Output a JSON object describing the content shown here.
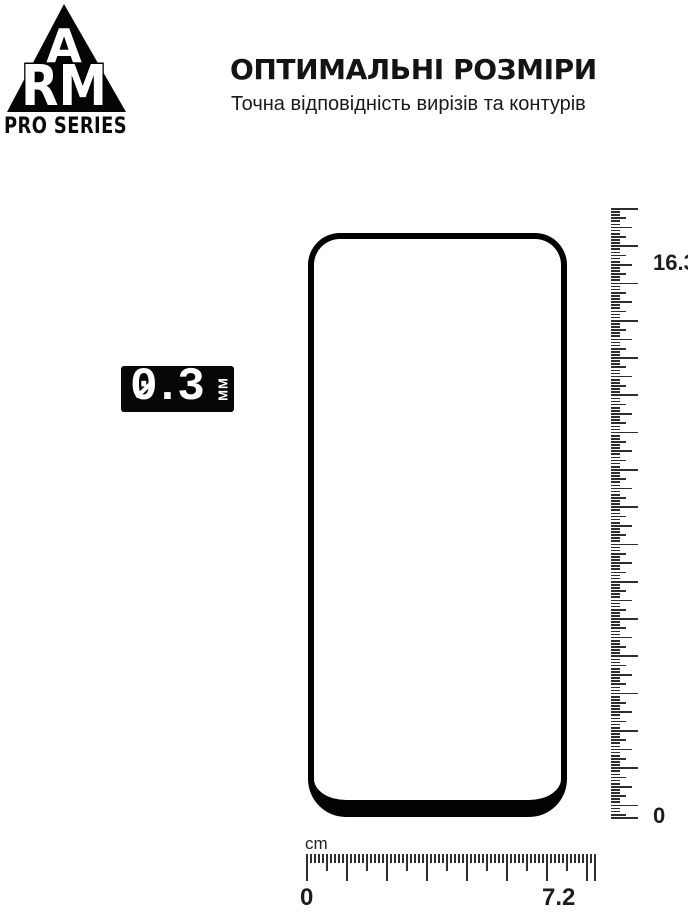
{
  "brand": {
    "letter_top": "A",
    "letters_main": "RM",
    "series": "PRO SERIES"
  },
  "header": {
    "title": "ОПТИМАЛЬНІ РОЗМІРИ",
    "subtitle": "Точна відповідність вирізів та контурів"
  },
  "thickness_badge": {
    "value": "0.3",
    "unit": "ММ"
  },
  "glass": {
    "height_cm": "16.3",
    "width_cm": "7.2",
    "thickness_mm": "0.3"
  },
  "rulers": {
    "vertical": {
      "max_label": "16.3",
      "min_label": "0",
      "geometry": {
        "orient": "v",
        "intervals": 196,
        "pattern": 12,
        "length": 609,
        "thick": 1.7,
        "len": {
          "major": 27,
          "half": 21,
          "quarter": 15,
          "minor": 9
        }
      }
    },
    "horizontal": {
      "unit_label": "cm",
      "min_label": "0",
      "max_label": "7.2",
      "geometry": {
        "orient": "h",
        "intervals": 72,
        "pattern": 10,
        "length": 288,
        "thick": 1.8,
        "len": {
          "major": 27,
          "half": 17,
          "quarter": 12,
          "minor": 9
        }
      }
    }
  },
  "colors": {
    "ink": "#0a0a0a",
    "tick_gray": "#2e2e2e",
    "background": "#ffffff"
  }
}
